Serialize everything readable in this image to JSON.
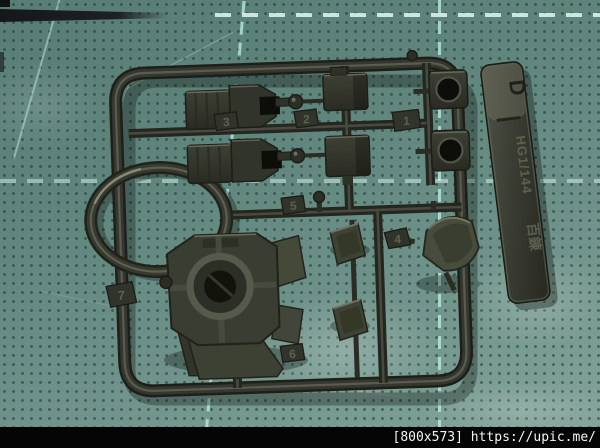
{
  "runner_tab": {
    "letter": "D",
    "scale_text": "HG1/144",
    "kit_name": "百錬"
  },
  "part_numbers": {
    "p1": "1",
    "p2": "2",
    "p3": "3",
    "p4": "4",
    "p5": "5",
    "p6": "6",
    "p7": "7"
  },
  "watermark": {
    "label": "[800x573] https://upic.me/"
  },
  "colors": {
    "mat_base": "#6b9188",
    "mat_dot": "#2f4a44",
    "mat_grid_line": "#baf0e2",
    "plastic_dark": "#20221b",
    "plastic_mid": "#33362c",
    "plastic_olive": "#454938",
    "plastic_highlight": "#6d7061",
    "footer_bg": "#050505",
    "footer_text": "#f5f5f5"
  }
}
